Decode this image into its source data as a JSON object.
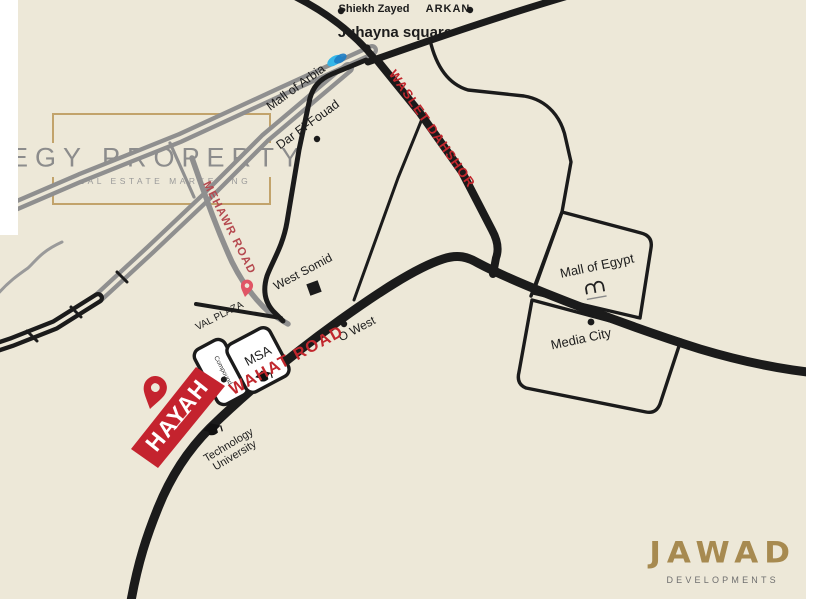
{
  "watermark": {
    "title": "EGY PROPERTY",
    "subtitle": "REAL ESTATE MARKETING"
  },
  "developer": {
    "name": "JAWAD",
    "tagline": "DEVELOPMENTS"
  },
  "project": {
    "name": "HAYAH",
    "marker": "location-pin-icon"
  },
  "map": {
    "road_labels": [
      {
        "name": "WAHAT ROAD"
      },
      {
        "name": "WASLET DAHSHOR"
      },
      {
        "name": "MEHAWR ROAD"
      }
    ],
    "places": [
      {
        "label": "Shiekh Zayed",
        "marker": "dot"
      },
      {
        "label": "ARKAN",
        "marker": "dot"
      },
      {
        "label": "Juhayna square",
        "marker": "dot"
      },
      {
        "label": "Mall of Arbia",
        "marker": "mall-of-arabia-logo-icon"
      },
      {
        "label": "Dar El-Fouad",
        "marker": "dot"
      },
      {
        "label": "West Somid",
        "marker": "building-square"
      },
      {
        "label": "VAL PLAZA",
        "marker": "location-pin-icon"
      },
      {
        "label": "MSA",
        "marker": "graduation-cap-icon"
      },
      {
        "label": "O West",
        "marker": "dot"
      },
      {
        "label": "Compound",
        "marker": "dot"
      },
      {
        "line1": "Technology",
        "line2": "University",
        "marker": "graduation-cap-icon"
      },
      {
        "label": "Mall of Egypt",
        "marker": "mall-of-egypt-logo-icon"
      },
      {
        "label": "Media City",
        "marker": "dot"
      }
    ]
  },
  "colors": {
    "background": "#EDE8D8",
    "road_main": "#1b1b1b",
    "road_secondary": "#8f8f8f",
    "road_label_red": "#c1272d",
    "mehawr_label_red": "#b5494f",
    "brand_red": "#c4232e",
    "pin_pink": "#e05565",
    "gold": "#a78a50",
    "watermark_gray": "#8c8c8c",
    "mall_arabia_blue": "#35b6e8"
  }
}
